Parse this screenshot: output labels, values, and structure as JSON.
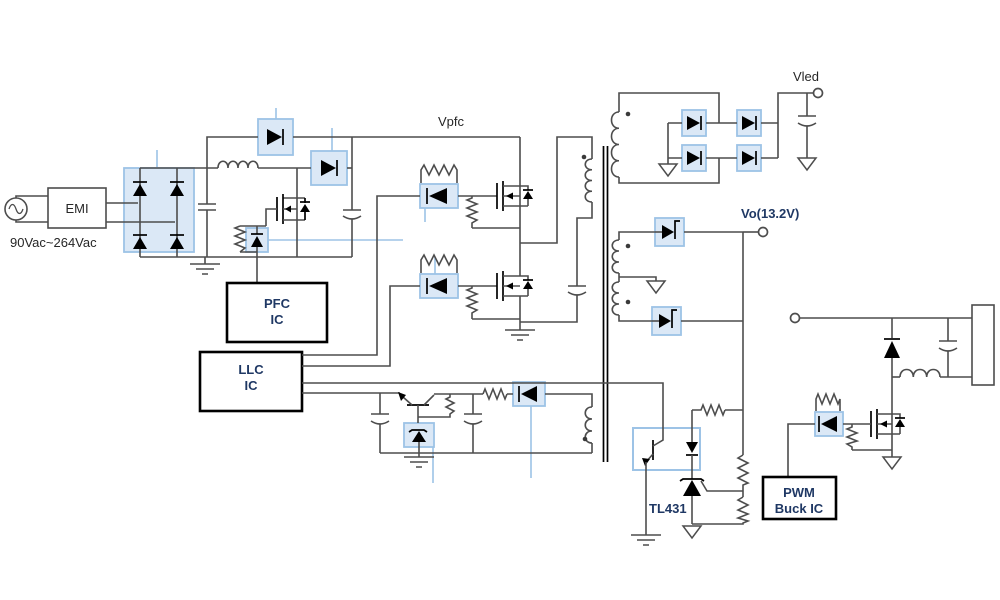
{
  "title": "AC-DC LED driver power supply schematic (EMI + PFC + LLC + PWM Buck)",
  "colors": {
    "wire": "#4d4d4d",
    "component": "#000000",
    "highlight_fill": "#dbe8f6",
    "highlight_border": "#9dc3e6",
    "connector": "#9dc3e6",
    "ic_border": "#000000",
    "text_primary": "#262626",
    "text_navy": "#1f3864",
    "background": "#ffffff"
  },
  "labels": {
    "input_voltage": "90Vac~264Vac",
    "emi": "EMI",
    "vpfc": "Vpfc",
    "vled": "Vled",
    "vo": "Vo(13.2V)",
    "tl431": "TL431",
    "pfc_line1": "PFC",
    "pfc_line2": "IC",
    "llc_line1": "LLC",
    "llc_line2": "IC",
    "pwm_line1": "PWM",
    "pwm_line2": "Buck IC"
  },
  "components": [
    "ac-source",
    "emi-filter",
    "bridge-rectifier",
    "input-capacitor",
    "pfc-inductor",
    "bypass-diode",
    "boost-diode",
    "pfc-mosfet",
    "pfc-gate-network",
    "bulk-capacitor",
    "pfc-ic",
    "llc-ic",
    "llc-high-side-mosfet",
    "llc-low-side-mosfet",
    "high-side-gate-network",
    "low-side-gate-network",
    "resonant-capacitor",
    "transformer-primary",
    "transformer-core",
    "vled-secondary",
    "vled-bridge-rectifier",
    "vled-output-capacitor",
    "vled-terminal",
    "vo-secondary-center-tapped",
    "vo-rectifier-diodes",
    "vo-terminal",
    "aux-winding",
    "aux-rectifier-diode",
    "series-pass-transistor",
    "zener-diode",
    "optocoupler",
    "tl431-shunt-regulator",
    "feedback-divider",
    "buck-input-terminal",
    "freewheel-diode",
    "buck-inductor",
    "buck-output-capacitor",
    "load-block",
    "buck-mosfet",
    "buck-gate-network",
    "pwm-buck-ic"
  ]
}
